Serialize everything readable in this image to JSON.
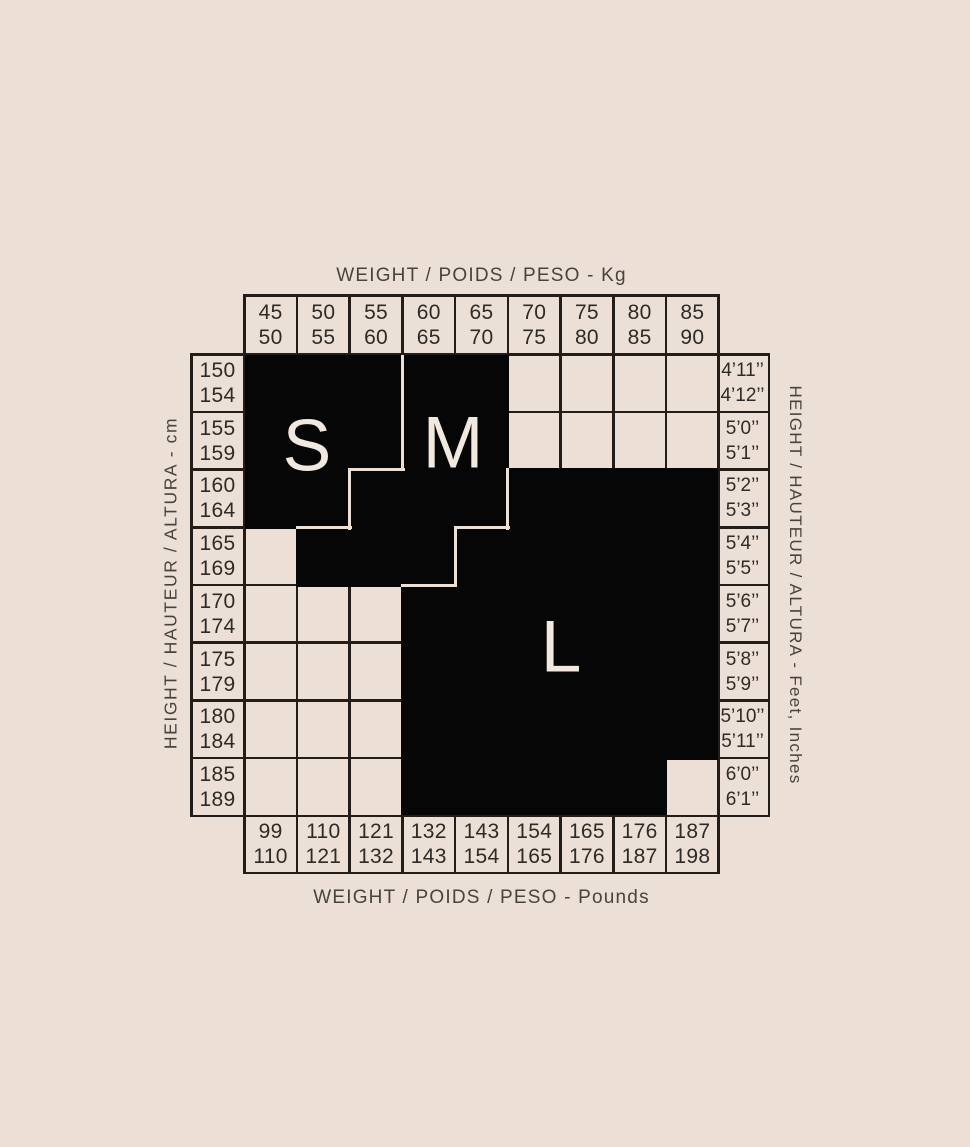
{
  "labels": {
    "top": "WEIGHT / POIDS / PESO - Kg",
    "bottom": "WEIGHT / POIDS / PESO - Pounds",
    "left": "HEIGHT / HAUTEUR / ALTURA - cm",
    "right": "HEIGHT / HAUTEUR / ALTURA - Feet, Inches"
  },
  "sizes": {
    "s": "S",
    "m": "M",
    "l": "L"
  },
  "weight_kg": [
    [
      "45",
      "50"
    ],
    [
      "50",
      "55"
    ],
    [
      "55",
      "60"
    ],
    [
      "60",
      "65"
    ],
    [
      "65",
      "70"
    ],
    [
      "70",
      "75"
    ],
    [
      "75",
      "80"
    ],
    [
      "80",
      "85"
    ],
    [
      "85",
      "90"
    ]
  ],
  "weight_lb": [
    [
      "99",
      "110"
    ],
    [
      "110",
      "121"
    ],
    [
      "121",
      "132"
    ],
    [
      "132",
      "143"
    ],
    [
      "143",
      "154"
    ],
    [
      "154",
      "165"
    ],
    [
      "165",
      "176"
    ],
    [
      "176",
      "187"
    ],
    [
      "187",
      "198"
    ]
  ],
  "height_cm": [
    [
      "150",
      "154"
    ],
    [
      "155",
      "159"
    ],
    [
      "160",
      "164"
    ],
    [
      "165",
      "169"
    ],
    [
      "170",
      "174"
    ],
    [
      "175",
      "179"
    ],
    [
      "180",
      "184"
    ],
    [
      "185",
      "189"
    ]
  ],
  "height_ft": [
    [
      "4’11’’",
      "4’12’’"
    ],
    [
      "5’0’’",
      "5’1’’"
    ],
    [
      "5’2’’",
      "5’3’’"
    ],
    [
      "5’4’’",
      "5’5’’"
    ],
    [
      "5’6’’",
      "5’7’’"
    ],
    [
      "5’8’’",
      "5’9’’"
    ],
    [
      "5’10’’",
      "5’11’’"
    ],
    [
      "6’0’’",
      "6’1’’"
    ]
  ],
  "colors": {
    "background": "#ecdfd6",
    "region_black": "#070606",
    "grid_line": "#221d19",
    "letter_cream": "#f1e8df",
    "label_gray": "#49433e"
  },
  "chart_data": {
    "type": "heatmap",
    "title": "Garment size chart (S / M / L) by weight and height",
    "x_axis_top_label": "WEIGHT / POIDS / PESO - Kg",
    "x_axis_bottom_label": "WEIGHT / POIDS / PESO - Pounds",
    "y_axis_left_label": "HEIGHT / HAUTEUR / ALTURA - cm",
    "y_axis_right_label": "HEIGHT / HAUTEUR / ALTURA - Feet, Inches",
    "x_categories_kg": [
      "45-50",
      "50-55",
      "55-60",
      "60-65",
      "65-70",
      "70-75",
      "75-80",
      "80-85",
      "85-90"
    ],
    "x_categories_lb": [
      "99-110",
      "110-121",
      "121-132",
      "132-143",
      "143-154",
      "154-165",
      "165-176",
      "176-187",
      "187-198"
    ],
    "y_categories_cm": [
      "150-154",
      "155-159",
      "160-164",
      "165-169",
      "170-174",
      "175-179",
      "180-184",
      "185-189"
    ],
    "y_categories_ft": [
      "4'11''-4'12''",
      "5'0''-5'1''",
      "5'2''-5'3''",
      "5'4''-5'5''",
      "5'6''-5'7''",
      "5'8''-5'9''",
      "5'10''-5'11''",
      "6'0''-6'1''"
    ],
    "legend_position": "none",
    "grid": true,
    "matrix_rows_top_to_bottom": [
      [
        "S",
        "S",
        "S",
        "M",
        "M",
        "",
        "",
        "",
        ""
      ],
      [
        "S",
        "S",
        "S",
        "M",
        "M",
        "",
        "",
        "",
        ""
      ],
      [
        "S",
        "S",
        "M",
        "M",
        "M",
        "L",
        "L",
        "L",
        "L"
      ],
      [
        "",
        "M",
        "M",
        "M",
        "L",
        "L",
        "L",
        "L",
        "L"
      ],
      [
        "",
        "",
        "",
        "L",
        "L",
        "L",
        "L",
        "L",
        "L"
      ],
      [
        "",
        "",
        "",
        "L",
        "L",
        "L",
        "L",
        "L",
        "L"
      ],
      [
        "",
        "",
        "",
        "L",
        "L",
        "L",
        "L",
        "L",
        "L"
      ],
      [
        "",
        "",
        "",
        "L",
        "L",
        "L",
        "L",
        "L",
        ""
      ]
    ]
  }
}
